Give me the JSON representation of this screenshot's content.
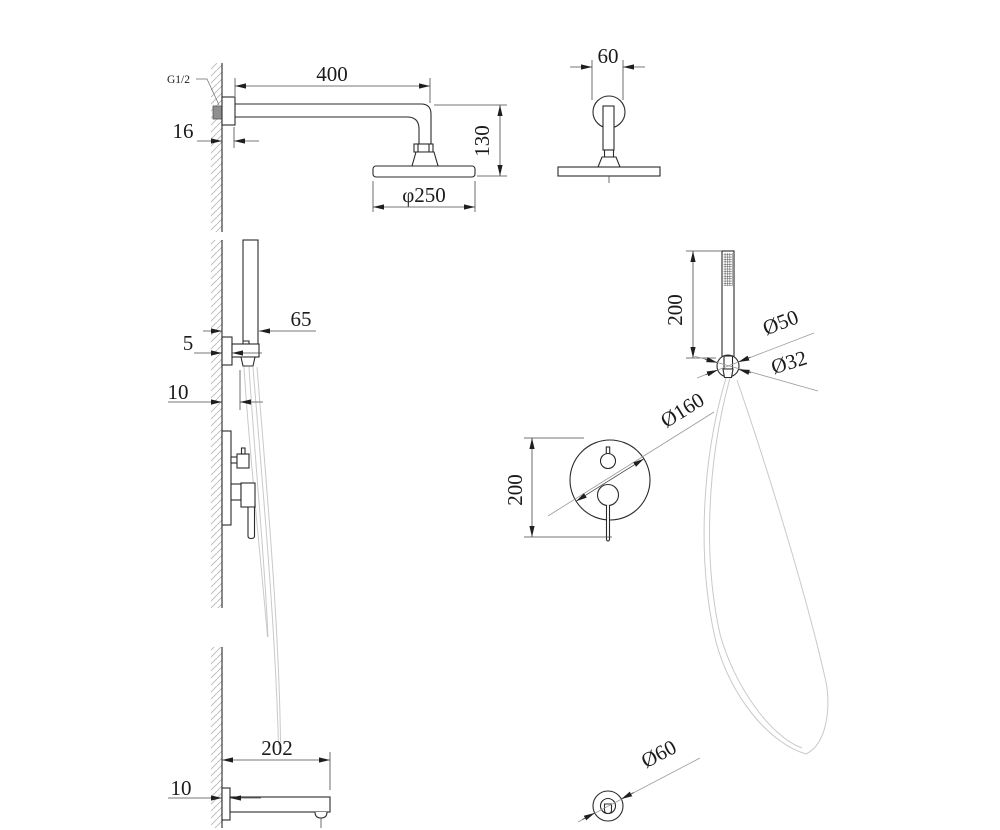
{
  "drawing": {
    "title": "shower-system-dimension-drawing",
    "figures": {
      "overhead_shower_side": {
        "thread_label": "G1/2",
        "arm_length": "400",
        "wall_offset": "16",
        "drop_height": "130",
        "head_diameter": "φ250"
      },
      "overhead_shower_front": {
        "flange_width": "60"
      },
      "hand_shower_holder_side": {
        "holder_depth": "65",
        "plate_offset": "5",
        "outlet_offset": "10"
      },
      "hand_shower_front": {
        "handle_length": "200",
        "cone_diameter": "Ø50",
        "nut_diameter": "Ø32"
      },
      "mixer_front": {
        "plate_diameter": "Ø160",
        "body_height": "200"
      },
      "spout_side": {
        "spout_length": "202",
        "flange_depth": "10"
      },
      "spout_front": {
        "outlet_diameter": "Ø60"
      }
    }
  }
}
